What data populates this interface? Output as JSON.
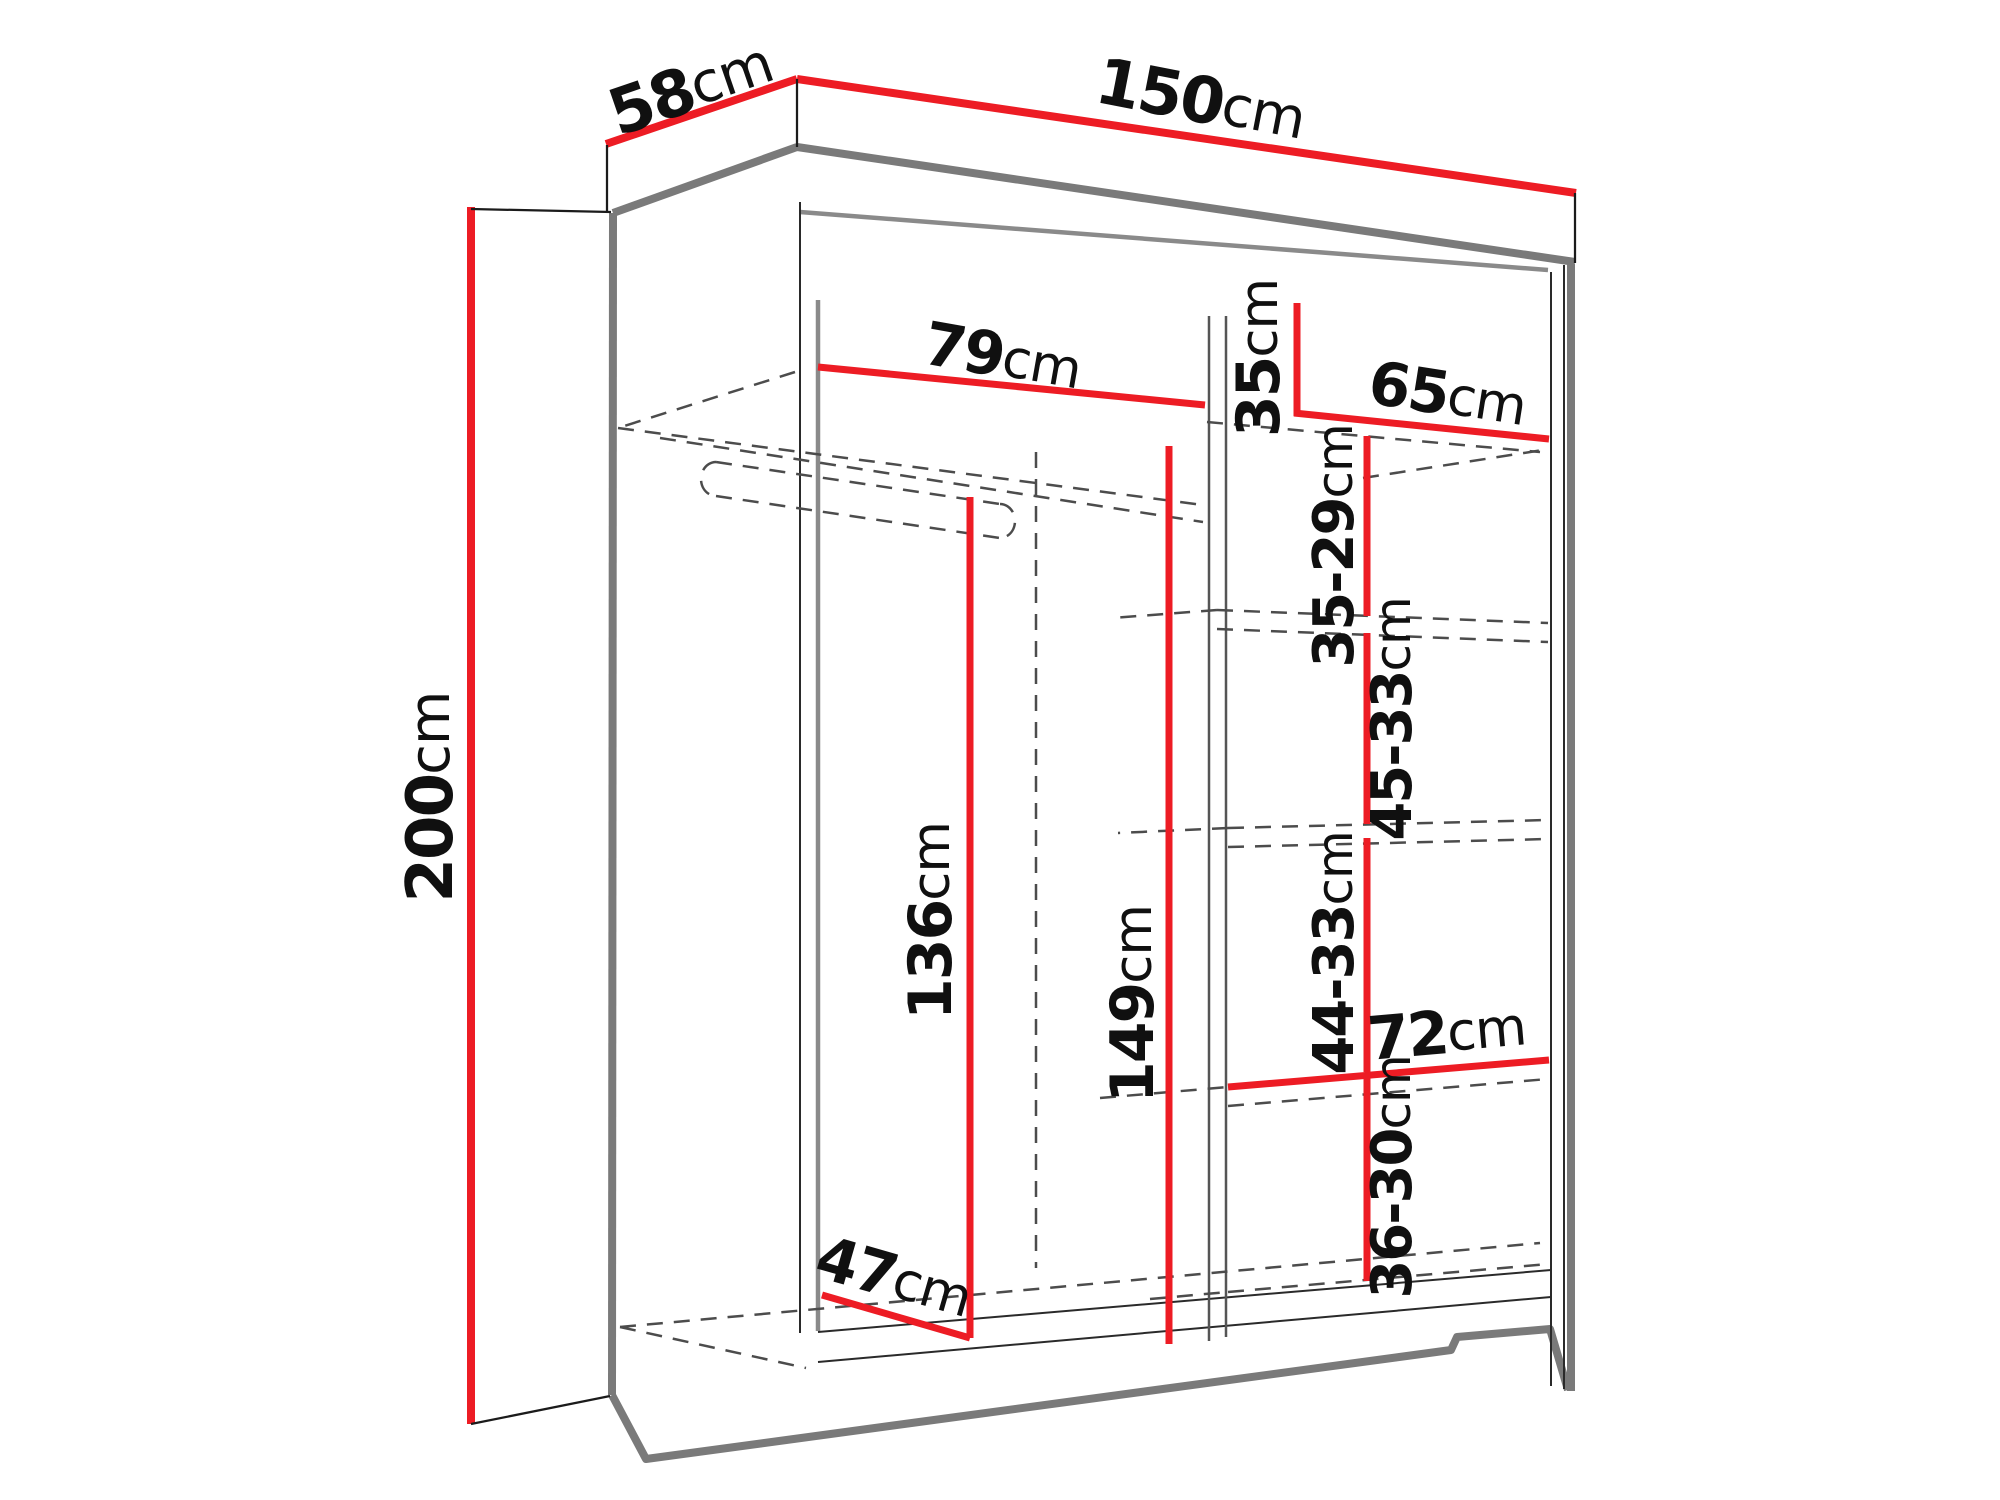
{
  "diagram": {
    "kind": "wardrobe-dimension-diagram",
    "unit": "cm",
    "colors": {
      "dimension_line": "#ed1c24",
      "outline_gray": "#7a7a7a",
      "structure_black": "#1b1b1b",
      "hidden_edge_dash": "#4c4c4c",
      "label_text": "#101010",
      "background": "#ffffff"
    }
  },
  "dimensions": {
    "depth": {
      "value": "58",
      "unit": "cm"
    },
    "width": {
      "value": "150",
      "unit": "cm"
    },
    "height": {
      "value": "200",
      "unit": "cm"
    },
    "top_shelf_width": {
      "value": "79",
      "unit": "cm"
    },
    "top_right_height": {
      "value": "35",
      "unit": "cm"
    },
    "right_section_width": {
      "value": "65",
      "unit": "cm"
    },
    "right_shelf_spacing_1": {
      "value": "35-29",
      "unit": "cm"
    },
    "right_shelf_spacing_2": {
      "value": "45-33",
      "unit": "cm"
    },
    "right_shelf_spacing_3": {
      "value": "44-33",
      "unit": "cm"
    },
    "lower_right_width": {
      "value": "72",
      "unit": "cm"
    },
    "right_shelf_spacing_4": {
      "value": "36-30",
      "unit": "cm"
    },
    "hanging_space_height": {
      "value": "136",
      "unit": "cm"
    },
    "interior_height": {
      "value": "149",
      "unit": "cm"
    },
    "interior_depth": {
      "value": "47",
      "unit": "cm"
    }
  }
}
